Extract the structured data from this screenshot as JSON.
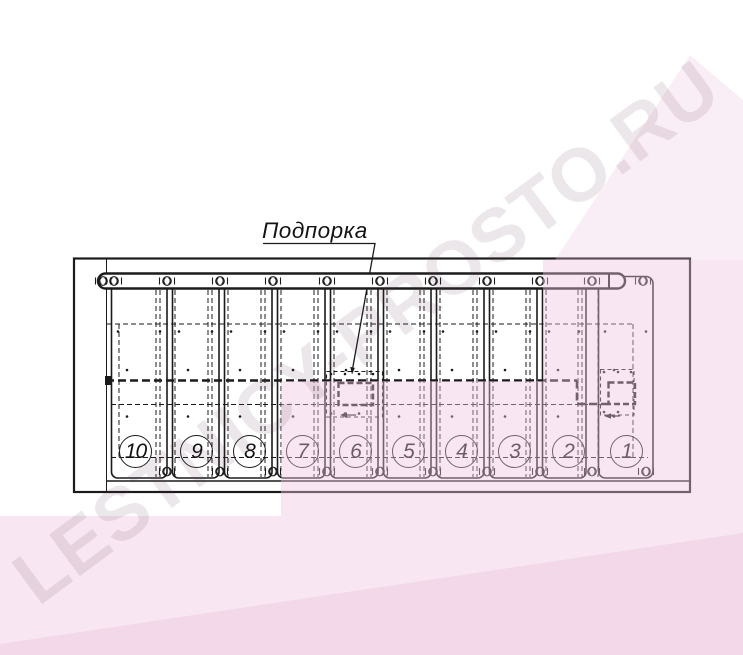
{
  "callout": {
    "label": "Подпорка"
  },
  "steps": {
    "labels": [
      "10",
      "9",
      "8",
      "7",
      "6",
      "5",
      "4",
      "3",
      "2",
      "1"
    ]
  },
  "watermark": {
    "text": "LESTNICY-PROSTO.RU"
  },
  "colors": {
    "line": "#1b1b1b",
    "paper": "#ffffff",
    "tint_pink": "#f7ebf3",
    "tint_pink_deep": "#f1e2ec",
    "watermark_gray": "#ebe7ea"
  }
}
